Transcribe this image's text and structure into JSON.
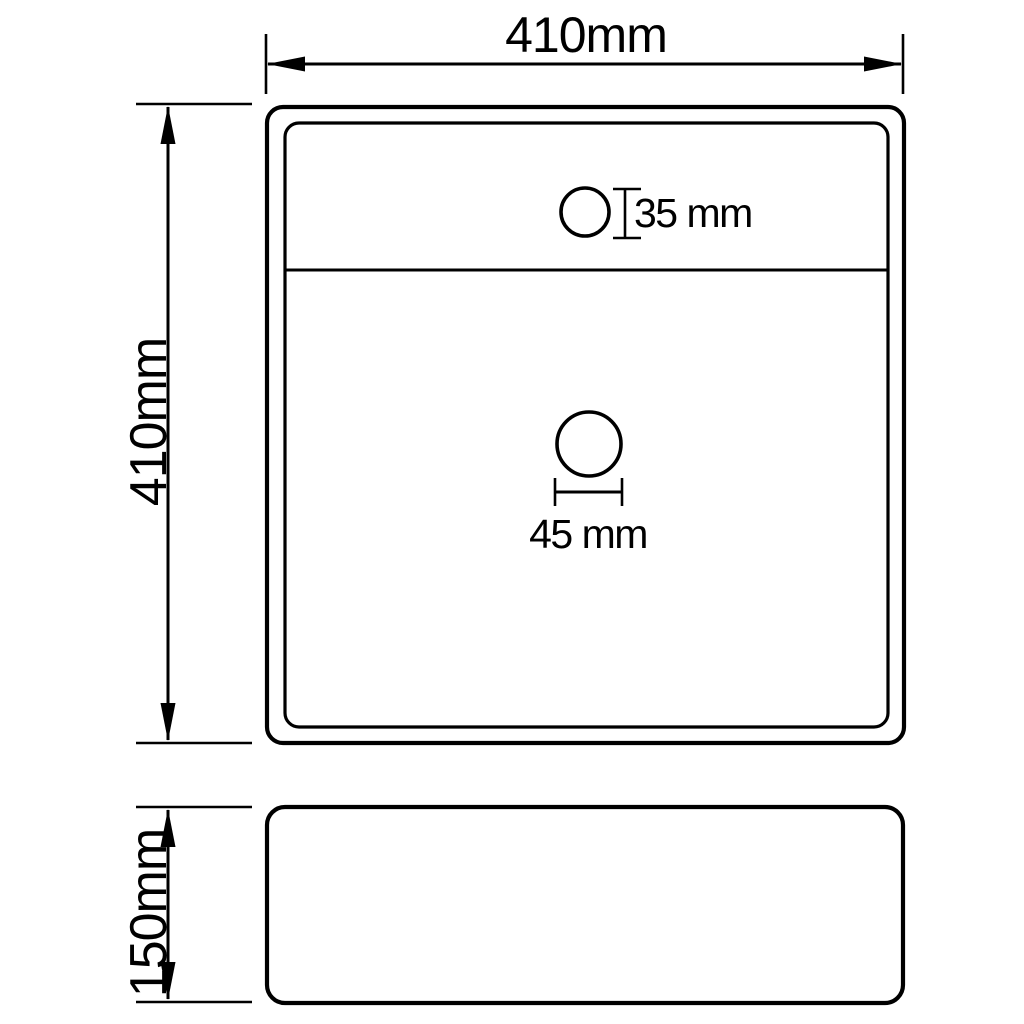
{
  "drawing": {
    "background_color": "#ffffff",
    "line_color": "#000000",
    "views": {
      "top": {
        "width_label": "410mm",
        "depth_label": "410mm",
        "faucet_hole_label": "35 mm",
        "drain_hole_label": "45 mm"
      },
      "side": {
        "height_label": "150mm"
      }
    }
  }
}
